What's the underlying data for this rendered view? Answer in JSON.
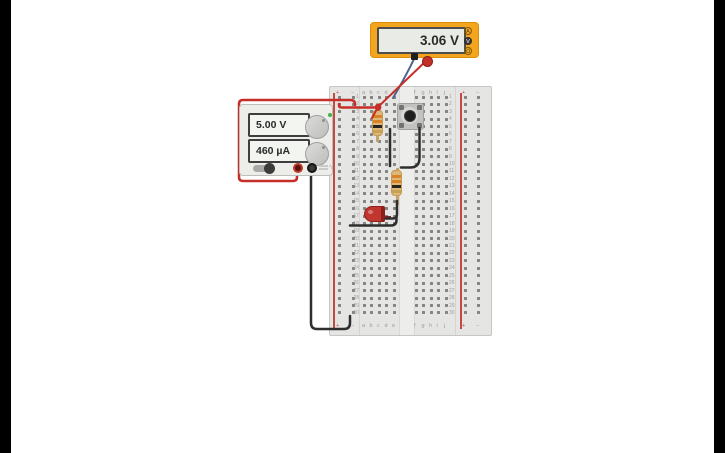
{
  "multimeter": {
    "reading": "3.06 V",
    "mode_buttons": [
      {
        "glyph": "A",
        "selected": false
      },
      {
        "glyph": "V",
        "selected": true
      },
      {
        "glyph": "Ω",
        "selected": false
      }
    ],
    "body_color": "#F3A51E"
  },
  "power_supply": {
    "voltage_display": "5.00 V",
    "current_display": "460 µA",
    "power_led_color": "#44B04A"
  },
  "breadboard": {
    "left_columns": [
      "a",
      "b",
      "c",
      "d",
      "e"
    ],
    "right_columns": [
      "f",
      "g",
      "h",
      "i",
      "j"
    ],
    "rows": 30,
    "plus": "+",
    "minus": "−"
  },
  "components": {
    "resistor1_bands": [
      "#D8832A",
      "#D8832A",
      "#2A2220",
      "#C9A154"
    ],
    "resistor2_bands": [
      "#D8832A",
      "#D8832A",
      "#2A2220",
      "#C9A154"
    ],
    "led_color": "#C23630"
  },
  "wires": {
    "supply_positive": "#C62F28",
    "supply_negative": "#2E2E2E",
    "probe_positive": "#C62F28",
    "probe_negative": "#4A6291"
  }
}
